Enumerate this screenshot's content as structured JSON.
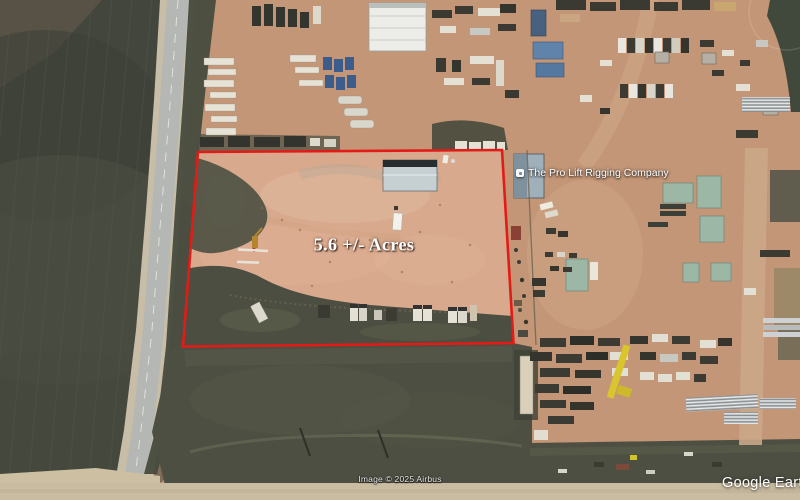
{
  "watermark": {
    "text": "Google Earth"
  },
  "attribution": {
    "text": "Image © 2025 Airbus"
  },
  "property_overlay": {
    "acreage_label": "5.6 +/- Acres",
    "boundary_color": "#e31b17"
  },
  "map_labels": {
    "place": {
      "label": "The Pro Lift Rigging Company",
      "icon": "place-icon"
    }
  },
  "scene_colors": {
    "industrial_yard_dirt": "#c39677",
    "outlined_lot_dirt": "#d8a98c",
    "plowed_field": "#43463c",
    "grass": "#4b4e40",
    "road": "#b4b7b3"
  }
}
